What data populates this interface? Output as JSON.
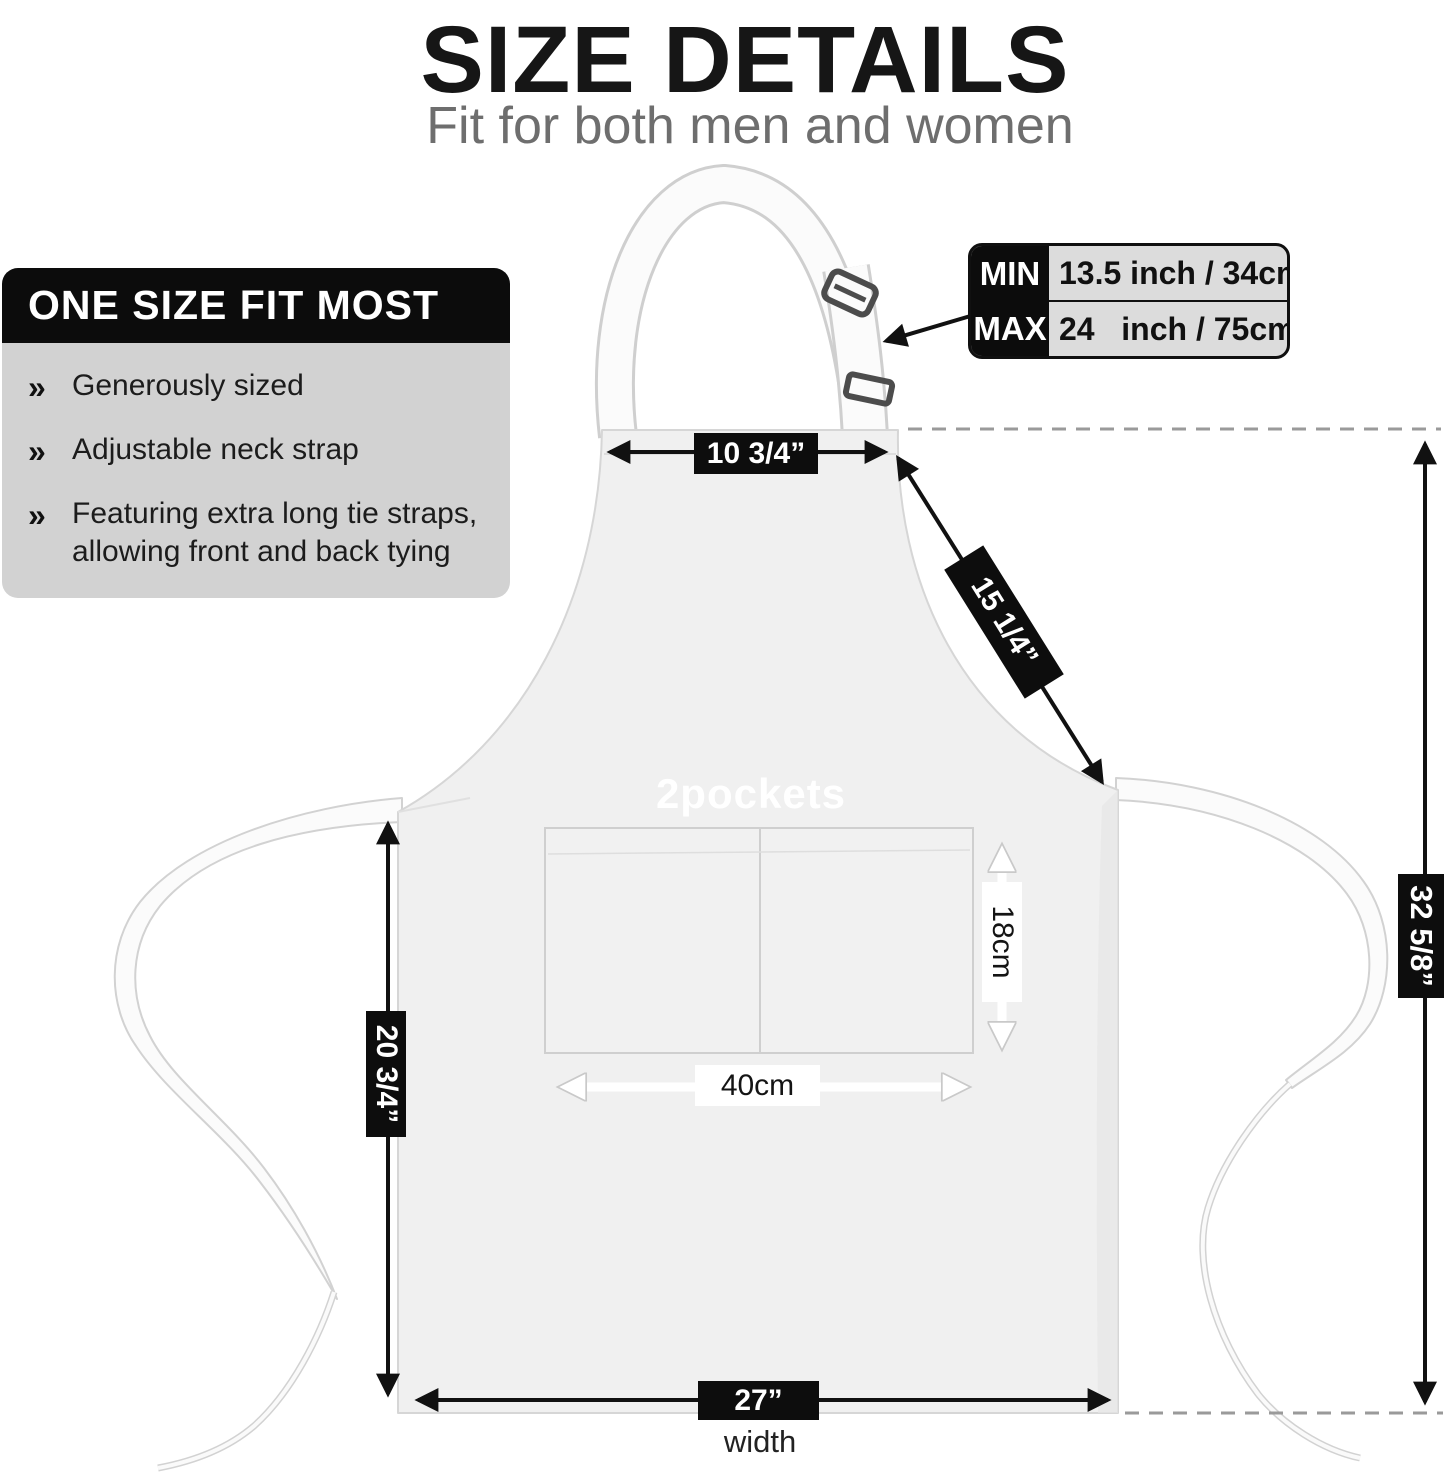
{
  "header": {
    "title": "SIZE DETAILS",
    "subtitle": "Fit for both men and women"
  },
  "features_panel": {
    "header": "ONE SIZE FIT MOST",
    "bullet_glyph": "»",
    "bullets": [
      "Generously sized",
      "Adjustable neck strap",
      "Featuring extra long tie straps, allowing front and back tying"
    ]
  },
  "neck_strap_table": {
    "rows": [
      {
        "label": "MIN",
        "value": "13.5 inch / 34cm"
      },
      {
        "label": "MAX",
        "value": "24   inch / 75cm"
      }
    ]
  },
  "measurements": {
    "neck_opening_width": "10 3/4”",
    "bib_diagonal": "15 1/4”",
    "total_height": "32 5/8”",
    "skirt_height": "20 3/4”",
    "pocket_height": "18cm",
    "pocket_width": "40cm",
    "bottom_width": "27”",
    "bottom_width_caption": "width"
  },
  "apron": {
    "pockets_label": "2pockets"
  },
  "colors": {
    "label_bg": "#0d0d0d",
    "panel_body_bg": "#d2d2d2",
    "apron_fill": "#f0f0f0",
    "subtitle_gray": "#6e6e6e"
  }
}
